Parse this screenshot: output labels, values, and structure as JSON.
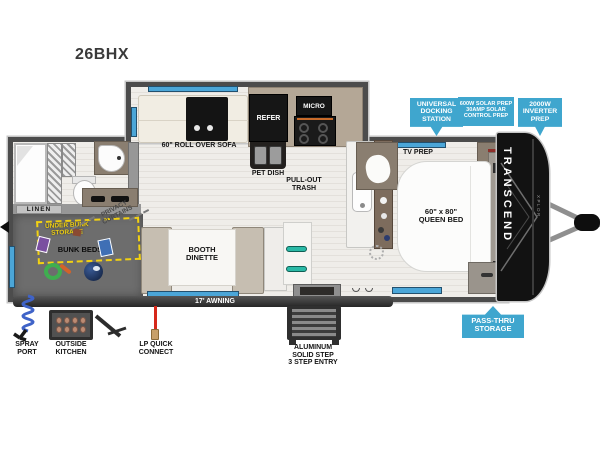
{
  "title": "26BHX",
  "brand": {
    "name": "TRANSCEND",
    "sub": "XPLOR"
  },
  "colors": {
    "callout_blue": "#3FA6CE",
    "storage_yellow": "#F2D112",
    "window_blue": "#4BA6D8",
    "lp_red": "#D6281A"
  },
  "callouts": {
    "universal_docking": {
      "lines": [
        "UNIVERSAL",
        "DOCKING",
        "STATION"
      ]
    },
    "solar_prep": {
      "lines": [
        "600W SOLAR PREP",
        "30AMP SOLAR",
        "CONTROL PREP"
      ]
    },
    "inverter_prep": {
      "lines": [
        "2000W",
        "INVERTER",
        "PREP"
      ]
    },
    "pass_thru": {
      "lines": [
        "PASS-THRU",
        "STORAGE"
      ]
    }
  },
  "exterior": {
    "spray_port": {
      "lines": [
        "SPRAY",
        "PORT"
      ]
    },
    "outside_kitchen": {
      "lines": [
        "OUTSIDE",
        "KITCHEN"
      ]
    },
    "lp_quick_connect": {
      "lines": [
        "LP QUICK",
        "CONNECT"
      ]
    },
    "entry_step": {
      "lines": [
        "ALUMINUM",
        "SOLID STEP",
        "3 STEP ENTRY"
      ]
    },
    "awning": "17' AWNING"
  },
  "rooms": {
    "sofa": "60\" ROLL OVER SOFA",
    "refer": "REFER",
    "micro": "MICRO",
    "pet_dish": "PET DISH",
    "pull_out_trash": {
      "lines": [
        "PULL-OUT",
        "TRASH"
      ]
    },
    "tv_prep": "TV PREP",
    "queen_bed": {
      "lines": [
        "60\" x 80\"",
        "QUEEN BED"
      ]
    },
    "booth_dinette": {
      "lines": [
        "BOOTH",
        "DINETTE"
      ]
    },
    "under_bunk_storage": {
      "lines": [
        "UNDER BUNK",
        "STORAGE"
      ]
    },
    "bunk_beds": "BUNK BEDS",
    "linen": "LINEN",
    "privacy_curtains": {
      "lines": [
        "PRIVACY",
        "CURTAINS"
      ]
    }
  }
}
